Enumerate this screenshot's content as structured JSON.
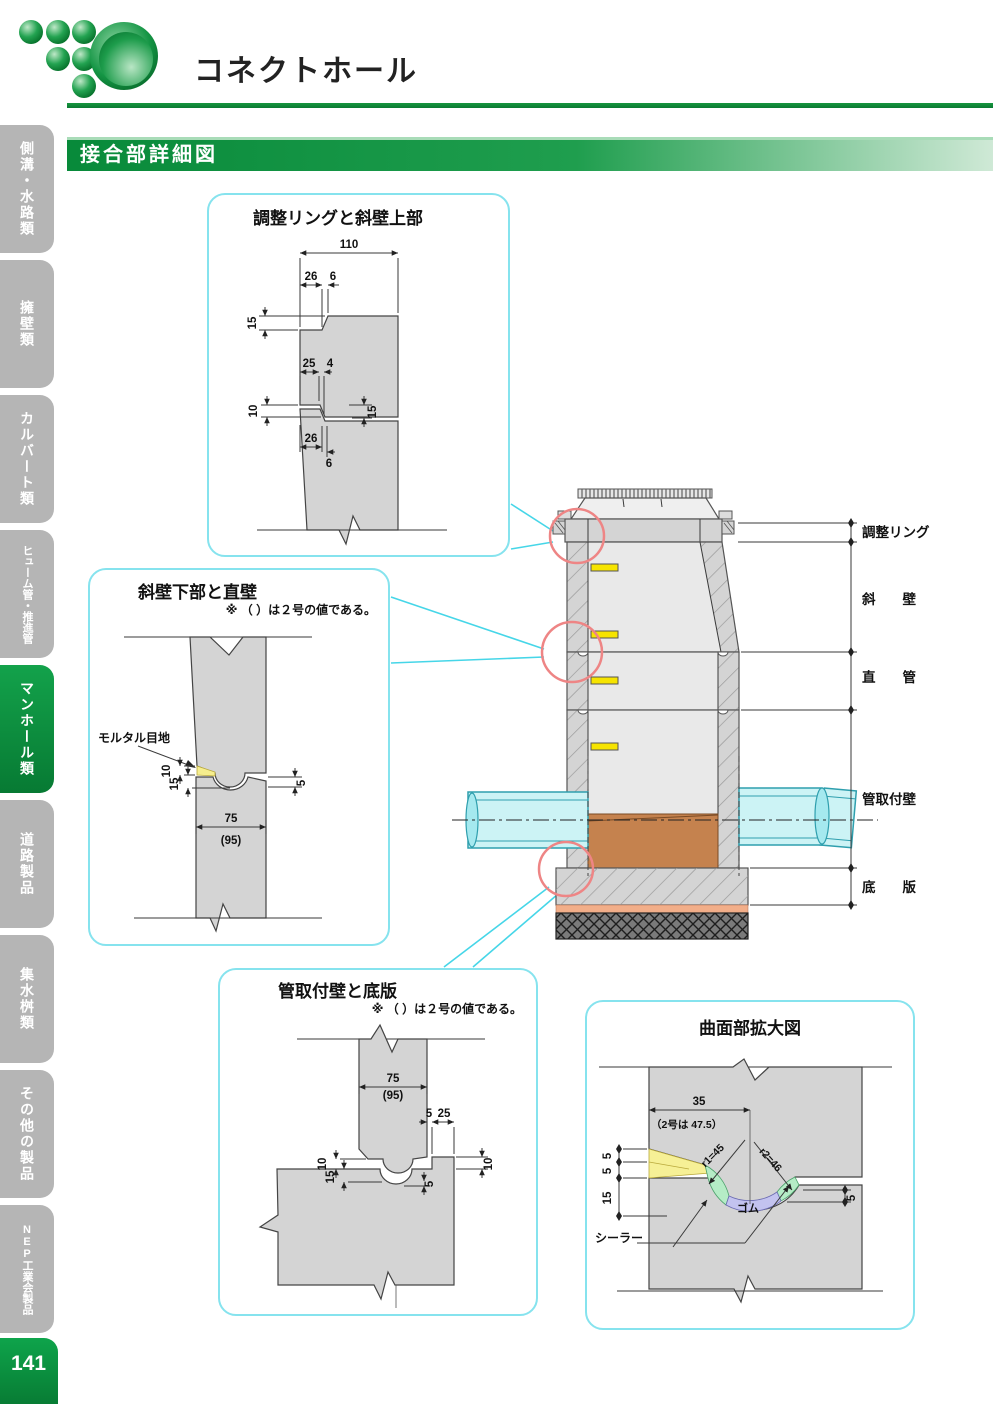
{
  "header": {
    "title": "コネクトホール",
    "section": "接合部詳細図"
  },
  "page": {
    "number": "141"
  },
  "sidebar": {
    "items": [
      {
        "label": "側溝・水路類",
        "active": false
      },
      {
        "label": "擁壁類",
        "active": false
      },
      {
        "label": "カルバート類",
        "active": false
      },
      {
        "label": "ヒューム管・推進管",
        "active": false
      },
      {
        "label": "マンホール類",
        "active": true
      },
      {
        "label": "道路製品",
        "active": false
      },
      {
        "label": "集水桝類",
        "active": false
      },
      {
        "label": "その他の製品",
        "active": false
      },
      {
        "label": "NEP工業会製品",
        "active": false
      }
    ]
  },
  "main_figure": {
    "labels": {
      "ring": "調整リング",
      "slope_wall": "斜　　壁",
      "straight": "直　　管",
      "pipe_wall": "管取付壁",
      "base": "底　　版"
    }
  },
  "detail1": {
    "title": "調整リングと斜壁上部",
    "dims": {
      "d110": "110",
      "d26a": "26",
      "d6a": "6",
      "d15a": "15",
      "d25": "25",
      "d4": "4",
      "d10": "10",
      "d15b": "15",
      "d26b": "26",
      "d6b": "6"
    }
  },
  "detail2": {
    "title": "斜壁下部と直壁",
    "note": "※ （ ）は２号の値である。",
    "mortar": "モルタル目地",
    "dims": {
      "d10": "10",
      "d15": "15",
      "d5": "5",
      "d75": "75",
      "d95": "(95)"
    }
  },
  "detail3": {
    "title": "管取付壁と底版",
    "note": "※ （ ）は２号の値である。",
    "dims": {
      "d75": "75",
      "d95": "(95)",
      "d5a": "5",
      "d25": "25",
      "d10a": "10",
      "d15": "15",
      "d5b": "5",
      "d10b": "10"
    }
  },
  "detail4": {
    "title": "曲面部拡大図",
    "note": "（2号は 47.5）",
    "rubber": "ゴム",
    "sealer": "シーラー",
    "dims": {
      "d35": "35",
      "d5a": "5",
      "d5b": "5",
      "d15": "15",
      "r1": "r1=45",
      "r2": "r2=46",
      "d5c": "5"
    }
  }
}
